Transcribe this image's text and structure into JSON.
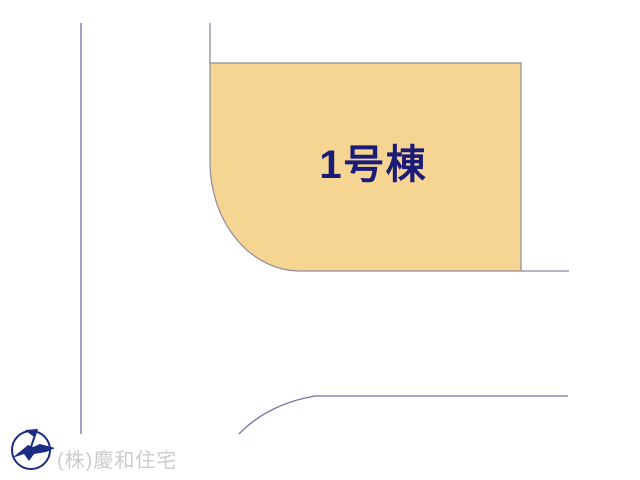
{
  "page": {
    "background_color": "#FFFFFF",
    "type": "real-estate-site-plan"
  },
  "plot": {
    "label": "1号棟",
    "fill": "#F6D592",
    "border_color": "#8F8C96",
    "label_color": "#1B1B78"
  },
  "roads": {
    "line_color": "#7070A8",
    "boundary_color": "#9B9BB5"
  },
  "footer": {
    "company_name": "(株)慶和住宅",
    "company_text_color": "#CCCCCC",
    "logo_color": "#1B2C85"
  }
}
